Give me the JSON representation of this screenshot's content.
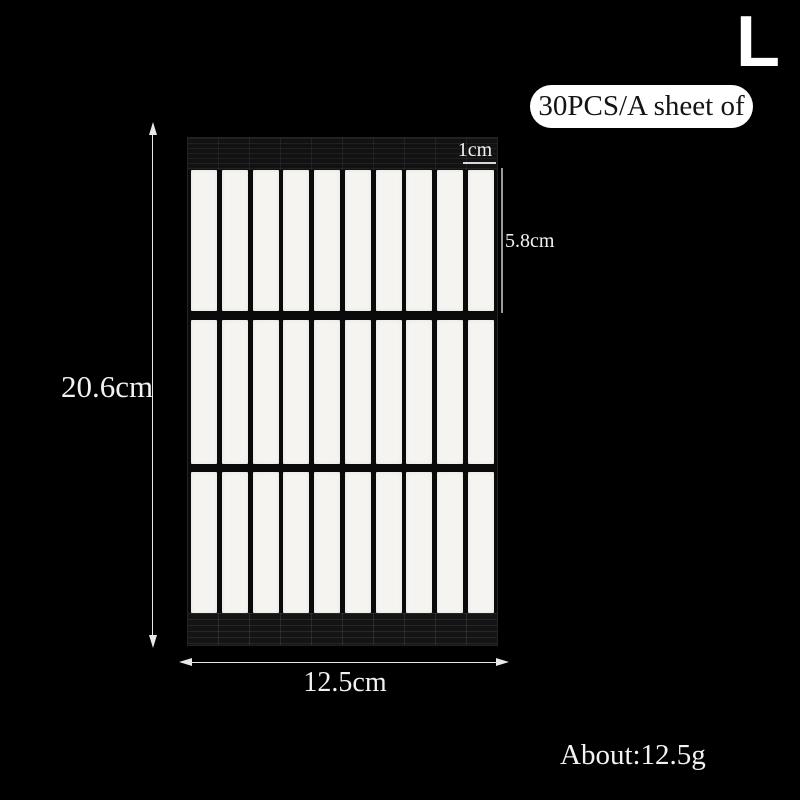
{
  "size_label": {
    "text": "L"
  },
  "badge": {
    "text": "30PCS/A sheet of"
  },
  "sheet": {
    "rows": 3,
    "columns": 10
  },
  "annotations": {
    "scale": {
      "text": "1cm"
    },
    "strip_height": {
      "text": "5.8cm"
    },
    "sheet_height": {
      "text": "20.6cm"
    },
    "sheet_width": {
      "text": "12.5cm"
    },
    "weight": {
      "text": "About:12.5g"
    }
  },
  "colors": {
    "background": "#000000",
    "text": "#f2f2f2",
    "badge_background": "#ffffff",
    "badge_text": "#141414",
    "sheet_background": "#0a0a0a",
    "strip": "#f5f4f1",
    "arrow": "#e8e8e8",
    "measure_line": "#9a9a9a"
  }
}
